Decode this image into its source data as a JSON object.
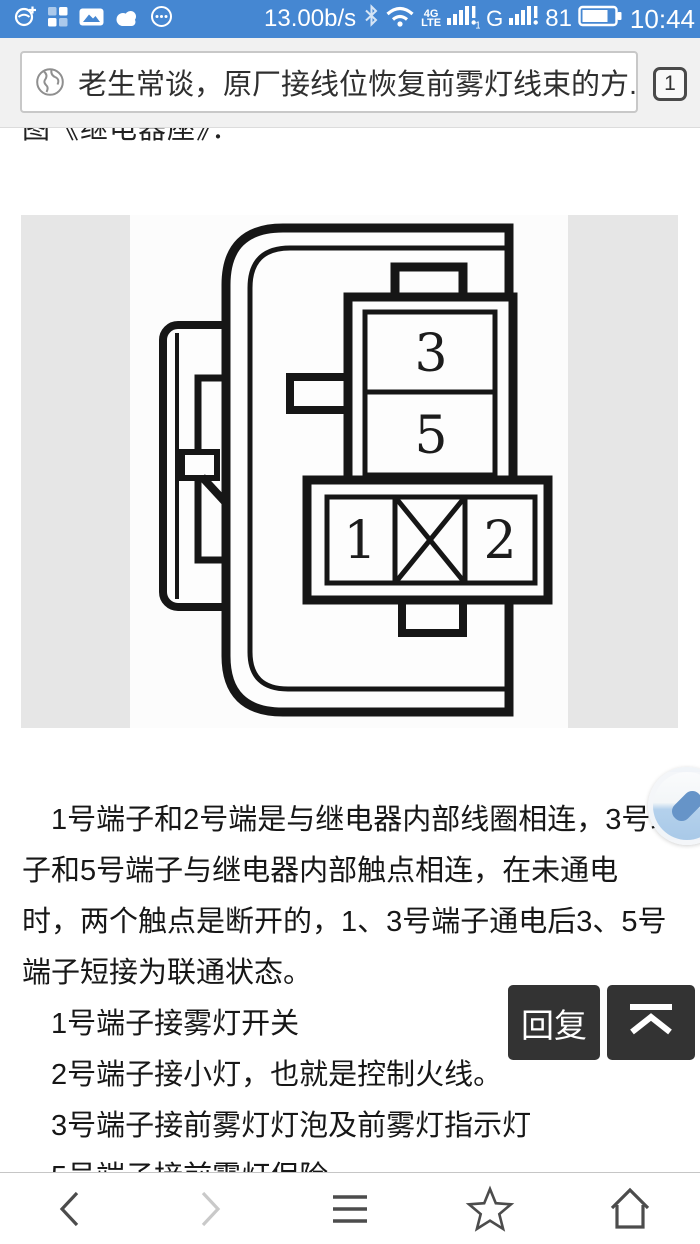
{
  "colors": {
    "status_bar_bg": "#4587d2",
    "chrome_bg": "#f1f1f1",
    "image_panel_gray": "#e6e6e6",
    "action_button_dark": "#333333",
    "nav_icon_gray": "#4c4c4c",
    "nav_icon_disabled": "#c9c9c9",
    "float_button_blue": "#6694c8"
  },
  "status_bar": {
    "left_icons": [
      "sync-icon",
      "grid-icon",
      "photo-icon",
      "cloud-icon",
      "more-icon"
    ],
    "net_speed": "13.00b/s",
    "bluetooth_icon": "bluetooth-icon",
    "wifi_icon": "wifi-icon",
    "network_type_top": "4G",
    "network_type_bottom": "LTE",
    "sim1_badge": "1",
    "carrier2_label": "G",
    "battery_percent": "81",
    "time": "10:44"
  },
  "address_bar": {
    "site_icon": "globe-icon",
    "title": "老生常谈，原厂接线位恢复前雾灯线束的方...",
    "tab_count": "1"
  },
  "content": {
    "clipped_heading": "图《继电器座》：",
    "diagram": {
      "description": "relay-socket-terminal-diagram",
      "terminal_3": "3",
      "terminal_5": "5",
      "terminal_1": "1",
      "terminal_2": "2"
    },
    "paragraph_lines": [
      "1号端子和2号端是与继电器内部线圈相连，3号端",
      "子和5号端子与继电器内部触点相连，在未通电",
      "时，两个触点是断开的，1、3号端子通电后3、5号",
      "端子短接为联通状态。"
    ],
    "list_lines": [
      "1号端子接雾灯开关",
      "2号端子接小灯，也就是控制火线。",
      "3号端子接前雾灯灯泡及前雾灯指示灯",
      "5号端子接前雾灯保险"
    ],
    "reply_button_label": "回复",
    "scroll_top_icon": "scroll-to-top-icon",
    "floating_button_icon": "floating-assistant-icon"
  },
  "nav_bar": {
    "icons": [
      "back-icon",
      "forward-icon",
      "menu-icon",
      "star-icon",
      "home-icon"
    ]
  }
}
